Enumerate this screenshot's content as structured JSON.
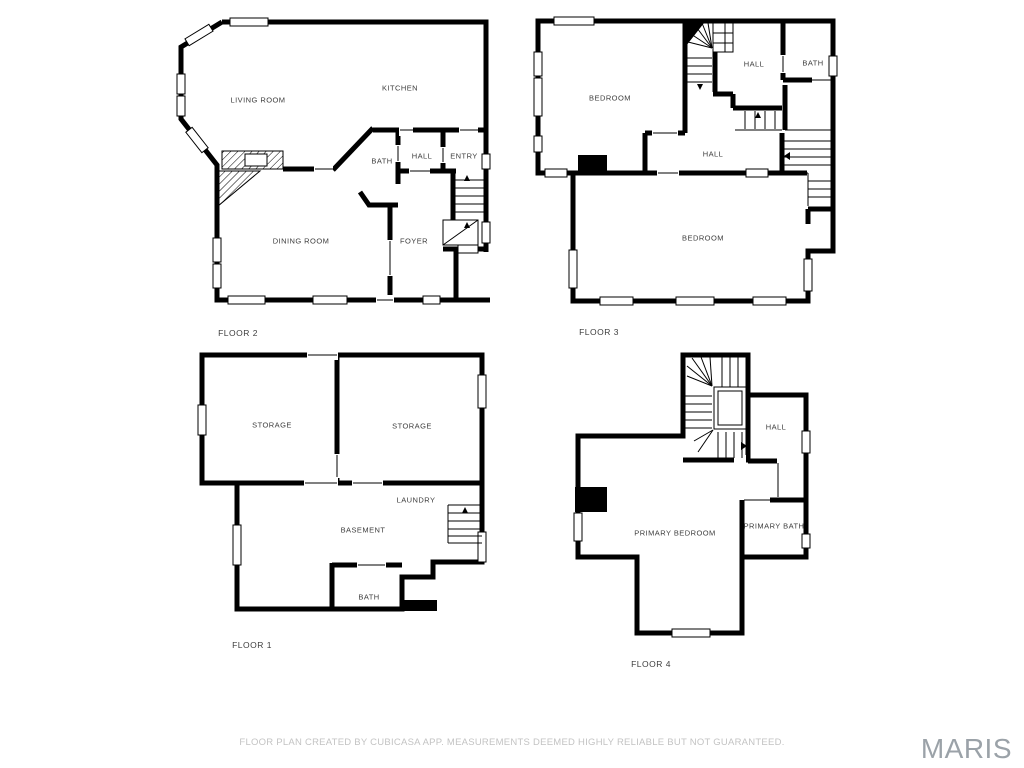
{
  "floors": [
    {
      "name": "FLOOR 2",
      "rooms": [
        {
          "label": "LIVING ROOM"
        },
        {
          "label": "KITCHEN"
        },
        {
          "label": "BATH"
        },
        {
          "label": "HALL"
        },
        {
          "label": "ENTRY"
        },
        {
          "label": "DINING ROOM"
        },
        {
          "label": "FOYER"
        }
      ]
    },
    {
      "name": "FLOOR 3",
      "rooms": [
        {
          "label": "BEDROOM"
        },
        {
          "label": "HALL"
        },
        {
          "label": "BATH"
        },
        {
          "label": "HALL"
        },
        {
          "label": "BEDROOM"
        }
      ]
    },
    {
      "name": "FLOOR 1",
      "rooms": [
        {
          "label": "STORAGE"
        },
        {
          "label": "STORAGE"
        },
        {
          "label": "LAUNDRY"
        },
        {
          "label": "BASEMENT"
        },
        {
          "label": "BATH"
        }
      ]
    },
    {
      "name": "FLOOR 4",
      "rooms": [
        {
          "label": "HALL"
        },
        {
          "label": "PRIMARY BEDROOM"
        },
        {
          "label": "PRIMARY BATH"
        }
      ]
    }
  ],
  "footer": {
    "disclaimer": "FLOOR PLAN CREATED BY CUBICASA APP. MEASUREMENTS DEEMED HIGHLY RELIABLE BUT NOT GUARANTEED."
  },
  "watermark": {
    "text": "MARIS"
  },
  "colors": {
    "wall": "#000000",
    "room_label": "#3d3d3d",
    "disclaimer_text": "#c3c3c3",
    "watermark_text": "#9ba2a8"
  }
}
